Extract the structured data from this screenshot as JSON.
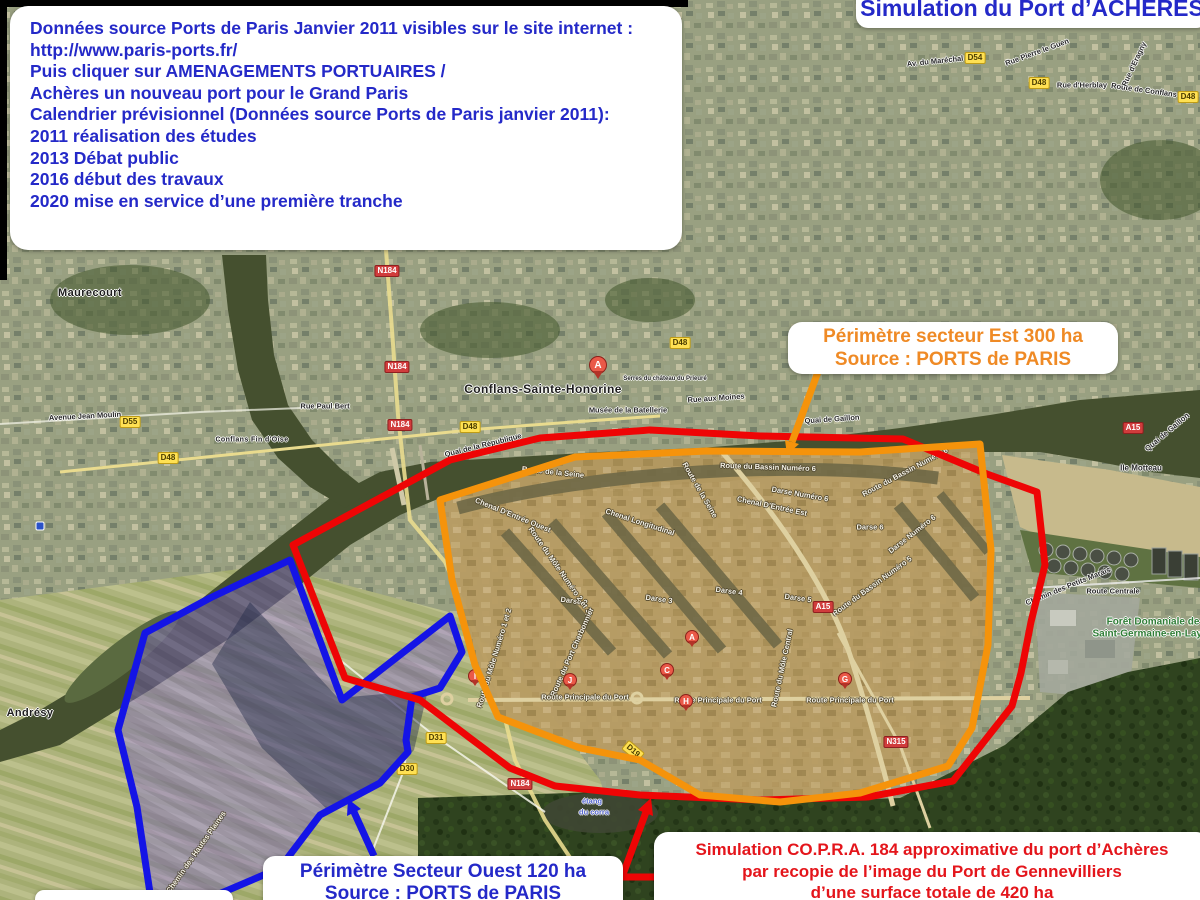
{
  "info_box": {
    "lines": [
      "Données source Ports de Paris Janvier 2011 visibles sur le site internet :",
      "http://www.paris-ports.fr/",
      "Puis cliquer sur AMENAGEMENTS PORTUAIRES /",
      "Achères un nouveau port pour le Grand Paris",
      "",
      "Calendrier prévisionnel (Données source Ports de Paris janvier 2011):",
      "2011 réalisation des études",
      "2013 Débat public",
      "2016 début des travaux",
      "2020 mise en service d’une première tranche"
    ]
  },
  "title_box": {
    "text": "Simulation du Port d’ACHÈRES"
  },
  "est_box": {
    "line1": "Périmètre secteur Est 300 ha",
    "line2": "Source : PORTS de PARIS"
  },
  "ouest_box": {
    "line1": "Périmètre Secteur Ouest 120 ha",
    "line2": "Source : PORTS de PARIS"
  },
  "copra_box": {
    "lines": [
      "Simulation CO.P.R.A. 184 approximative du port d’Achères",
      "par recopie de l’image du Port de Gennevilliers",
      "d’une surface totale de 420 ha"
    ]
  },
  "colors": {
    "accent_blue": "#2429c8",
    "accent_orange": "#ef8a25",
    "accent_red": "#e4151b",
    "outline_red": "#ee0505",
    "outline_orange": "#f5930b",
    "outline_blue": "#1414e6"
  },
  "map": {
    "towns": [
      {
        "t": "Maurecourt",
        "x": 90,
        "y": 293,
        "s": 11
      },
      {
        "t": "Conflans-Sainte-Honorine",
        "x": 543,
        "y": 389,
        "s": 12
      },
      {
        "t": "Andrésy",
        "x": 30,
        "y": 713,
        "s": 11
      },
      {
        "t": "Conflans Fin d'Oise",
        "x": 252,
        "y": 440,
        "s": 7
      }
    ],
    "streets": [
      {
        "t": "Avenue Jean Moulin",
        "x": 85,
        "y": 416,
        "r": -3
      },
      {
        "t": "Rue Paul Bert",
        "x": 325,
        "y": 406
      },
      {
        "t": "Quai de la République",
        "x": 483,
        "y": 445,
        "r": -14
      },
      {
        "t": "Musée de la Batellerie",
        "x": 628,
        "y": 410
      },
      {
        "t": "Serres du château du Prieuré",
        "x": 665,
        "y": 379,
        "s": 6
      },
      {
        "t": "Rue aux Moines",
        "x": 716,
        "y": 398,
        "r": -4
      },
      {
        "t": "Quai de Gaillon",
        "x": 832,
        "y": 419,
        "r": -4
      },
      {
        "t": "Quai de Gaillon",
        "x": 1167,
        "y": 432,
        "r": -40
      },
      {
        "t": "Ile Motteau",
        "x": 1141,
        "y": 468,
        "s": 8
      },
      {
        "t": "Rue d'Herblay",
        "x": 1082,
        "y": 85
      },
      {
        "t": "Route de Conflans",
        "x": 1144,
        "y": 90,
        "r": 8
      },
      {
        "t": "Rue d'Eragny",
        "x": 1134,
        "y": 64,
        "r": -65
      },
      {
        "t": "Av. du Maréchal Foch",
        "x": 945,
        "y": 60,
        "r": -6
      },
      {
        "t": "Rue Pierre le Guen",
        "x": 1037,
        "y": 52,
        "r": -20
      },
      {
        "t": "Route Centrale",
        "x": 1113,
        "y": 591
      },
      {
        "t": "Chemin des Hautes Plaines",
        "x": 196,
        "y": 852,
        "r": -55,
        "c": "w"
      },
      {
        "t": "Route de la Seine",
        "x": 553,
        "y": 472,
        "r": 6,
        "c": "w"
      },
      {
        "t": "Route de la Seine",
        "x": 700,
        "y": 490,
        "r": 60,
        "c": "w"
      },
      {
        "t": "Route du Bassin Numéro 6",
        "x": 768,
        "y": 467,
        "r": 2,
        "c": "w"
      },
      {
        "t": "Route du Bassin Numéro 6",
        "x": 905,
        "y": 472,
        "r": -28,
        "c": "w"
      },
      {
        "t": "Darse Numéro 6",
        "x": 800,
        "y": 494,
        "r": 10,
        "c": "w"
      },
      {
        "t": "Chenal D'Entrée Ouest",
        "x": 513,
        "y": 515,
        "r": 22,
        "c": "w"
      },
      {
        "t": "Chenal Longitudinal",
        "x": 640,
        "y": 522,
        "r": 18,
        "c": "w"
      },
      {
        "t": "Chenal D'Entrée Est",
        "x": 772,
        "y": 506,
        "r": 12,
        "c": "w"
      },
      {
        "t": "Darse 6",
        "x": 870,
        "y": 527,
        "c": "w"
      },
      {
        "t": "Darse Numéro 6",
        "x": 912,
        "y": 534,
        "r": -38,
        "c": "w"
      },
      {
        "t": "Darse 2",
        "x": 574,
        "y": 601,
        "r": 8,
        "c": "w"
      },
      {
        "t": "Darse 3",
        "x": 659,
        "y": 599,
        "r": 8,
        "c": "w"
      },
      {
        "t": "Darse 4",
        "x": 729,
        "y": 591,
        "r": 8,
        "c": "w"
      },
      {
        "t": "Darse 5",
        "x": 798,
        "y": 598,
        "r": 8,
        "c": "w"
      },
      {
        "t": "Route du Môle Numéro 2 et 3",
        "x": 560,
        "y": 570,
        "r": 55,
        "c": "w"
      },
      {
        "t": "Route du Bassin Numéro 5",
        "x": 872,
        "y": 586,
        "r": -36,
        "c": "w"
      },
      {
        "t": "Route du Môle Central",
        "x": 782,
        "y": 668,
        "r": -78,
        "c": "w"
      },
      {
        "t": "Route du Môle Numéro 1 et 2",
        "x": 494,
        "y": 658,
        "r": -73,
        "c": "w"
      },
      {
        "t": "Route du Port Charbonnier",
        "x": 572,
        "y": 652,
        "r": -66,
        "c": "w"
      },
      {
        "t": "Route Principale du Port",
        "x": 585,
        "y": 697,
        "c": "w"
      },
      {
        "t": "Route Principale du Port",
        "x": 718,
        "y": 700,
        "c": "w"
      },
      {
        "t": "Route Principale du Port",
        "x": 850,
        "y": 700,
        "c": "w"
      },
      {
        "t": "Chemin des Petits Marais",
        "x": 1068,
        "y": 586,
        "r": -22
      },
      {
        "t": "étang",
        "x": 592,
        "y": 801,
        "c": "blu"
      },
      {
        "t": "du corra",
        "x": 594,
        "y": 812,
        "c": "blu"
      },
      {
        "t": "Forêt Domaniale de",
        "x": 1153,
        "y": 622,
        "c": "grn",
        "s": 10
      },
      {
        "t": "Saint-Germaine-en-Laye",
        "x": 1150,
        "y": 634,
        "c": "grn",
        "s": 10
      }
    ],
    "shields": [
      {
        "t": "D55",
        "x": 130,
        "y": 422,
        "k": "y"
      },
      {
        "t": "D48",
        "x": 168,
        "y": 458,
        "k": "y"
      },
      {
        "t": "D48",
        "x": 470,
        "y": 427,
        "k": "y"
      },
      {
        "t": "D48",
        "x": 680,
        "y": 343,
        "k": "y"
      },
      {
        "t": "D54",
        "x": 975,
        "y": 58,
        "k": "y"
      },
      {
        "t": "D48",
        "x": 1039,
        "y": 83,
        "k": "y"
      },
      {
        "t": "D48",
        "x": 1188,
        "y": 97,
        "k": "y"
      },
      {
        "t": "D31",
        "x": 436,
        "y": 738,
        "k": "y"
      },
      {
        "t": "D30",
        "x": 407,
        "y": 769,
        "k": "y"
      },
      {
        "t": "D19",
        "x": 633,
        "y": 751,
        "k": "y",
        "r": 40
      },
      {
        "t": "N184",
        "x": 387,
        "y": 271,
        "k": "r"
      },
      {
        "t": "N184",
        "x": 397,
        "y": 367,
        "k": "r"
      },
      {
        "t": "N184",
        "x": 400,
        "y": 425,
        "k": "r"
      },
      {
        "t": "N184",
        "x": 520,
        "y": 784,
        "k": "r"
      },
      {
        "t": "N315",
        "x": 896,
        "y": 742,
        "k": "r"
      },
      {
        "t": "A15",
        "x": 823,
        "y": 607,
        "k": "r"
      },
      {
        "t": "A15",
        "x": 1133,
        "y": 428,
        "k": "r"
      }
    ],
    "markers": [
      {
        "t": "A",
        "x": 598,
        "y": 374,
        "big": true
      },
      {
        "t": "A",
        "x": 692,
        "y": 644
      },
      {
        "t": "C",
        "x": 667,
        "y": 677
      },
      {
        "t": "G",
        "x": 845,
        "y": 686
      },
      {
        "t": "H",
        "x": 686,
        "y": 708
      },
      {
        "t": "I",
        "x": 475,
        "y": 683
      },
      {
        "t": "J",
        "x": 570,
        "y": 687
      }
    ]
  }
}
